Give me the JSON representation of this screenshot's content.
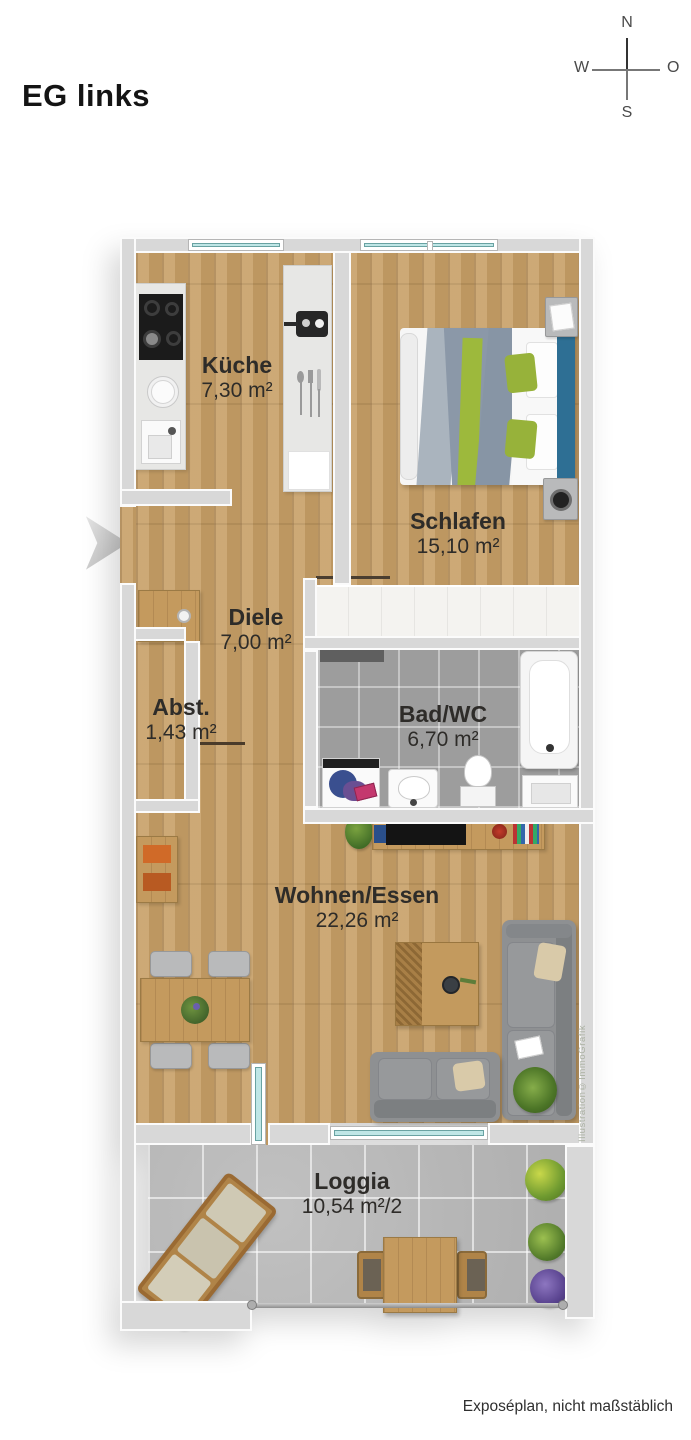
{
  "title": "EG links",
  "compass": {
    "north": "N",
    "east": "O",
    "south": "S",
    "west": "W"
  },
  "rooms": [
    {
      "id": "kueche",
      "name": "Küche",
      "area": "7,30 m²"
    },
    {
      "id": "schlafen",
      "name": "Schlafen",
      "area": "15,10 m²"
    },
    {
      "id": "diele",
      "name": "Diele",
      "area": "7,00 m²"
    },
    {
      "id": "abst",
      "name": "Abst.",
      "area": "1,43 m²"
    },
    {
      "id": "bad",
      "name": "Bad/WC",
      "area": "6,70 m²"
    },
    {
      "id": "wohnen",
      "name": "Wohnen/Essen",
      "area": "22,26 m²"
    },
    {
      "id": "loggia",
      "name": "Loggia",
      "area": "10,54 m²/2"
    }
  ],
  "watermark": "Illustration©ImmoGrafik",
  "footer": "Exposéplan, nicht maßstäblich",
  "colors": {
    "wood_floor": "#c79f66",
    "wall_gray": "#d8d8d8",
    "bath_tile": "#9d9d9d",
    "loggia_tile": "#b8b8b8",
    "window_glass": "#bfe6e6",
    "bed_headboard_blue": "#2e6f94",
    "accent_green": "#97b23a",
    "sofa_gray": "#8e9092",
    "label_text": "#2e2c29"
  }
}
